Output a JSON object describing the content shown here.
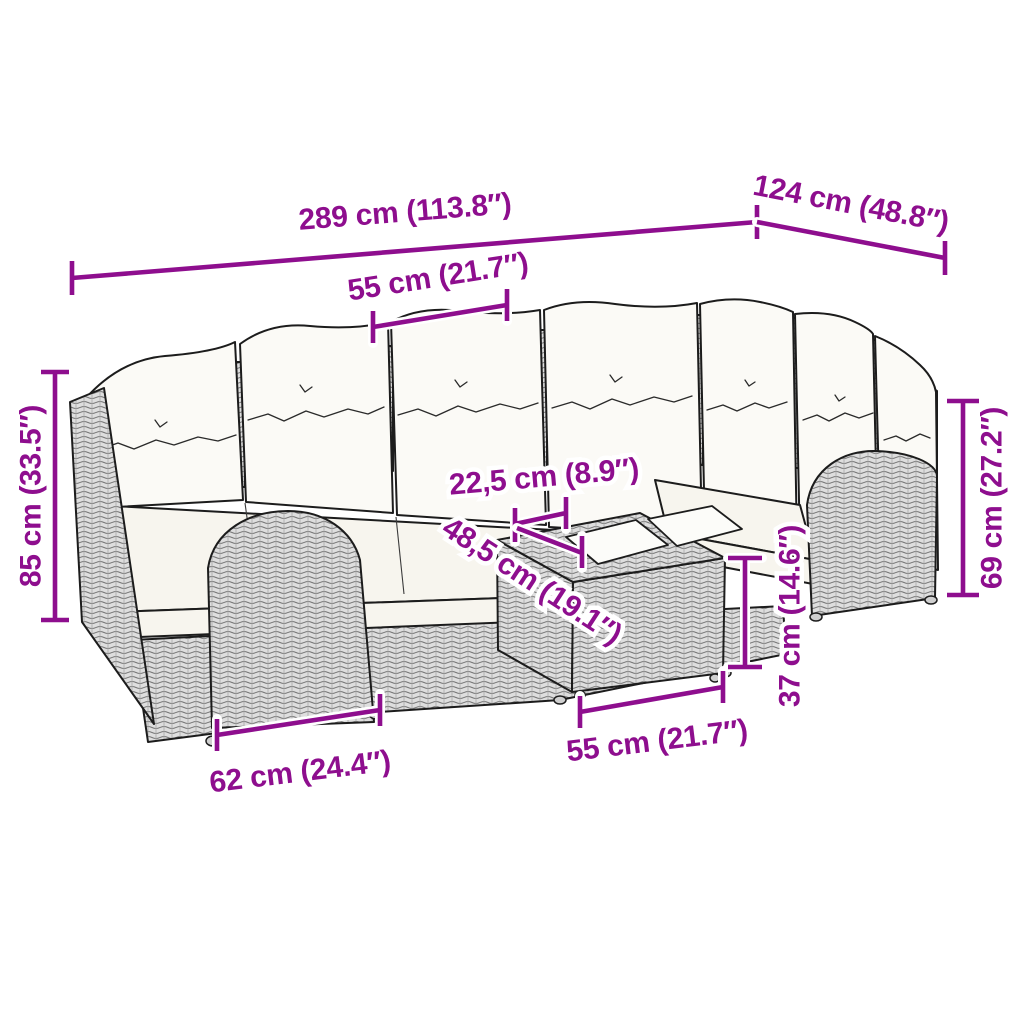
{
  "diagram": {
    "kind": "furniture-dimension-diagram",
    "subject": "rattan corner sofa set with cushions and ottoman tray table",
    "colors": {
      "dimension": "#8E0E8E",
      "outline": "#1c1c1c",
      "rattan_fill": "#dedede",
      "cushion_fill": "#fbfaf6",
      "background": "#ffffff"
    },
    "dims": {
      "total_width": "289 cm (113.8″)",
      "total_depth": "124 cm (48.8″)",
      "seat_width": "55 cm (21.7″)",
      "total_height": "85 cm (33.5″)",
      "arm_height": "69 cm (27.2″)",
      "table_gap": "22,5 cm (8.9″)",
      "table_depth": "48,5 cm (19.1″)",
      "table_height": "37 cm (14.6″)",
      "module_width": "62 cm (24.4″)",
      "table_width": "55 cm (21.7″)"
    }
  }
}
